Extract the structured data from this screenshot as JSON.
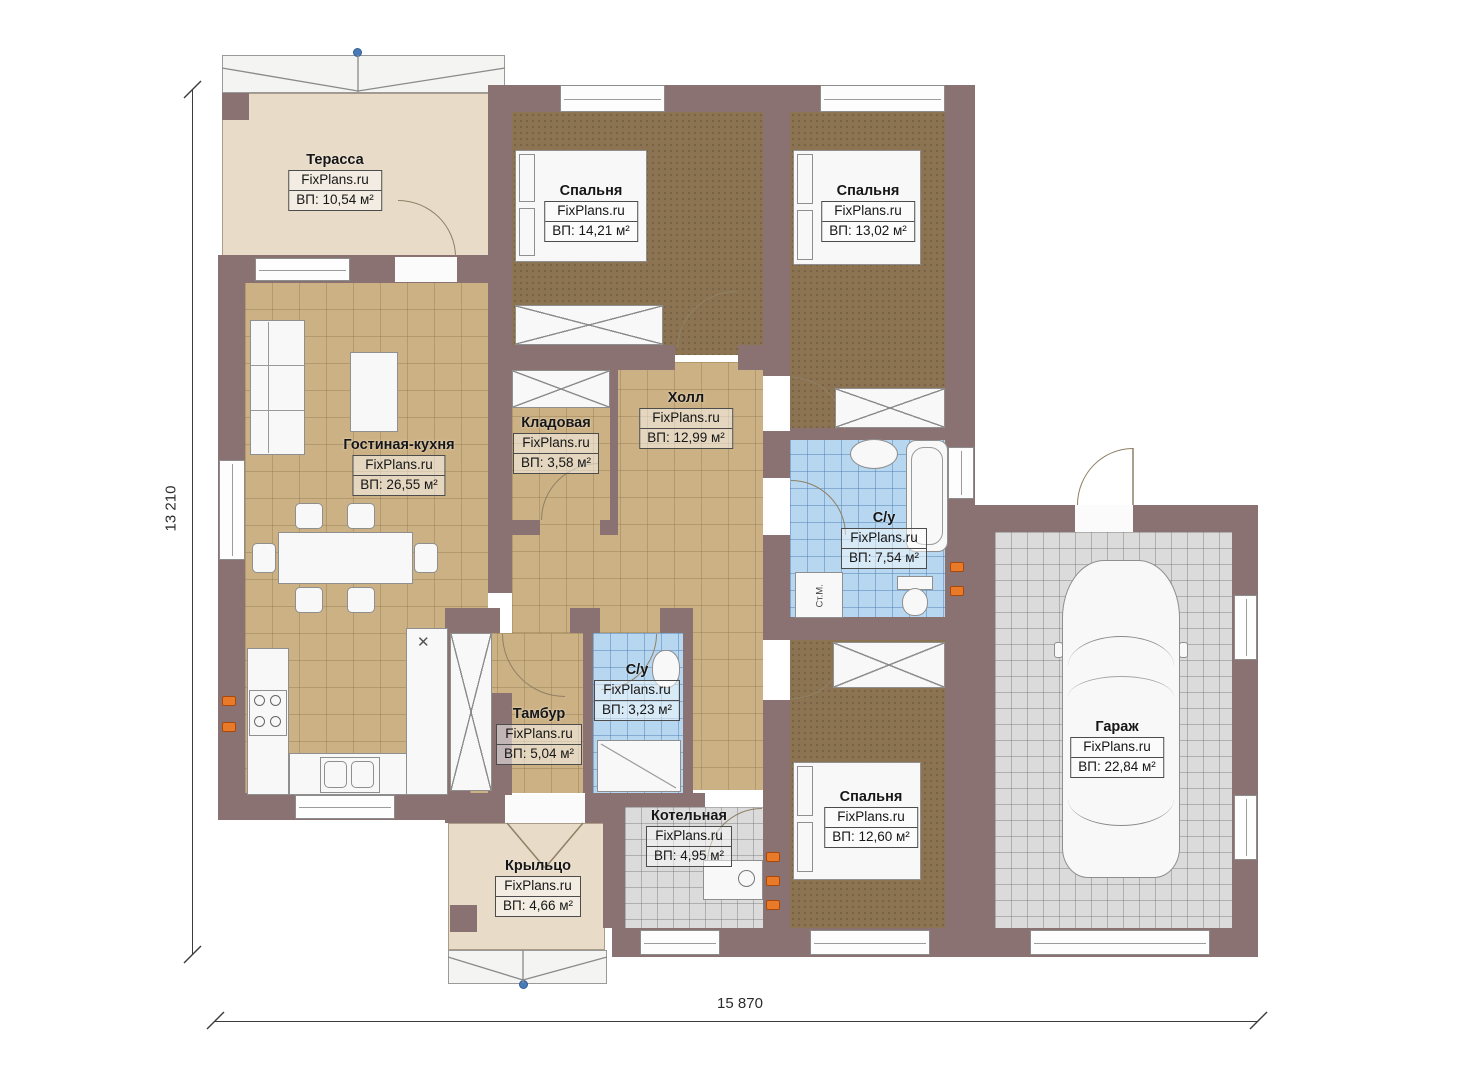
{
  "plan": {
    "watermark": "FixPlans.ru",
    "rooms": [
      {
        "name": "Терасса",
        "area": "ВП: 10,54 м²"
      },
      {
        "name": "Спальня",
        "area": "ВП: 14,21 м²"
      },
      {
        "name": "Спальня",
        "area": "ВП: 13,02 м²"
      },
      {
        "name": "Гостиная-кухня",
        "area": "ВП: 26,55 м²"
      },
      {
        "name": "Кладовая",
        "area": "ВП: 3,58 м²"
      },
      {
        "name": "Холл",
        "area": "ВП: 12,99 м²"
      },
      {
        "name": "С/у",
        "area": "ВП: 7,54 м²"
      },
      {
        "name": "Тамбур",
        "area": "ВП: 5,04 м²"
      },
      {
        "name": "С/у",
        "area": "ВП: 3,23 м²"
      },
      {
        "name": "Котельная",
        "area": "ВП: 4,95 м²"
      },
      {
        "name": "Спальня",
        "area": "ВП: 12,60 м²"
      },
      {
        "name": "Гараж",
        "area": "ВП: 22,84 м²"
      },
      {
        "name": "Крыльцо",
        "area": "ВП: 4,66 м²"
      }
    ],
    "dimensions": {
      "bottom": "15 870",
      "left": "13 210"
    },
    "labels": {
      "washing_machine": "Ст.М."
    },
    "colors": {
      "wall": "#8A7272",
      "floor_tile_tan": "#CCB184",
      "floor_carpet_brown": "#8C7453",
      "floor_tile_blue": "#B7D6EF",
      "floor_tile_gray": "#DBDBDB",
      "floor_beige": "#E8DBC8",
      "outlet_orange": "#E87A2A",
      "marker_blue": "#4A7AB5"
    }
  }
}
